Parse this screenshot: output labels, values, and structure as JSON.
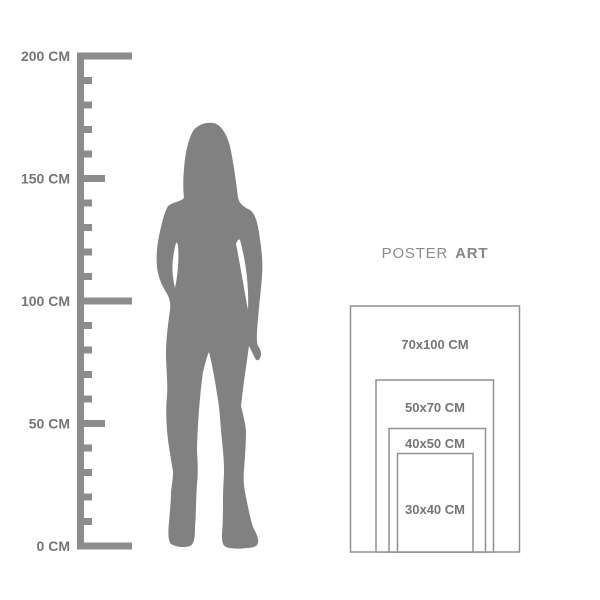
{
  "ruler": {
    "unit": "CM",
    "labels": [
      {
        "value": 200,
        "text": "200 CM"
      },
      {
        "value": 150,
        "text": "150 CM"
      },
      {
        "value": 100,
        "text": "100 CM"
      },
      {
        "value": 50,
        "text": "50 CM"
      },
      {
        "value": 0,
        "text": "0 CM"
      }
    ]
  },
  "title": {
    "brand_regular": "POSTER",
    "brand_bold": "ART"
  },
  "poster_sizes": [
    {
      "label": "70x100 CM"
    },
    {
      "label": "50x70 CM"
    },
    {
      "label": "40x50 CM"
    },
    {
      "label": "30x40 CM"
    }
  ],
  "colors": {
    "silhouette": "#818181",
    "ruler": "#8c8c8c",
    "label_text": "#757575",
    "brand_text": "#8b8b8b",
    "rect_border": "#919191",
    "background": "#ffffff"
  }
}
